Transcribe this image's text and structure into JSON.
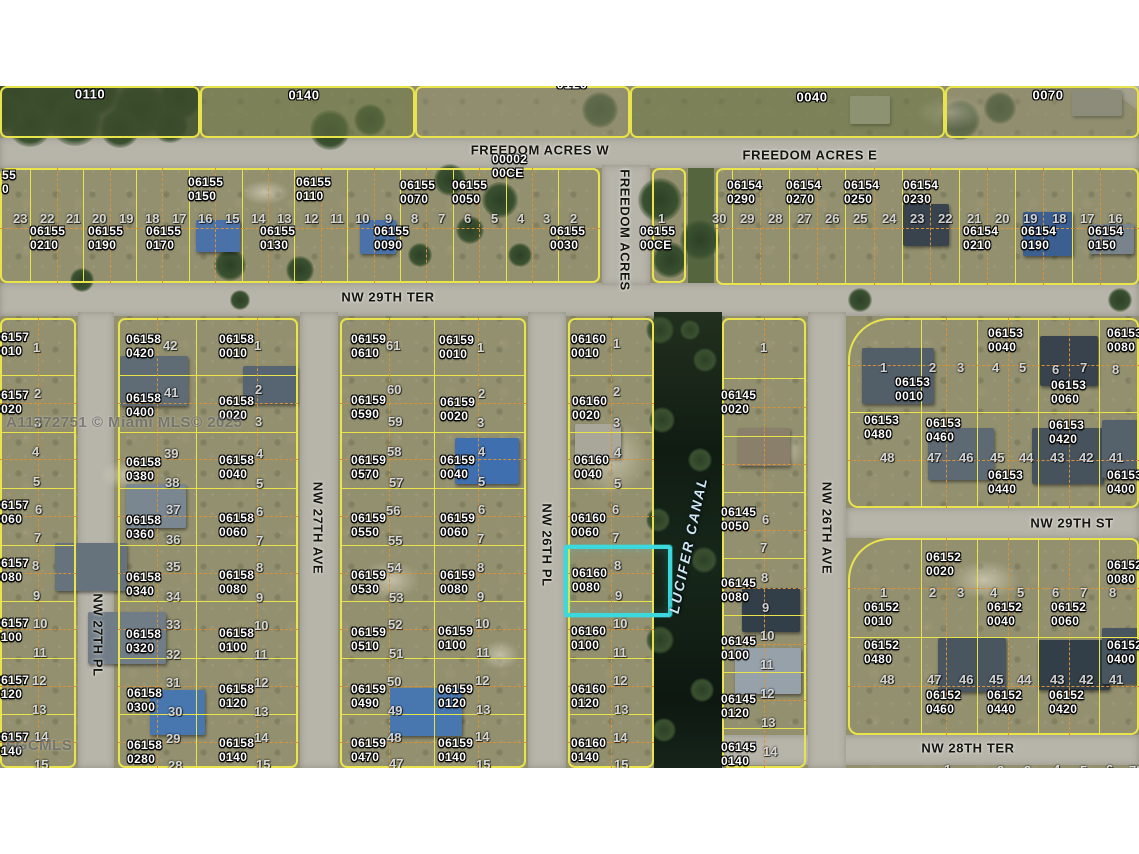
{
  "watermark": {
    "main": "A11772751 © Miami MLS© 2025",
    "corner": "FGCMLS"
  },
  "highlight": {
    "parcel_id": "06160 0080",
    "x": 564,
    "y": 545,
    "w": 100,
    "h": 64,
    "color": "#3bd9de"
  },
  "canal_label": [
    "LUCIFER CANAL",
    688,
    545,
    -78
  ],
  "streets": [
    [
      "FREEDOM ACRES W",
      540,
      150,
      0
    ],
    [
      "FREEDOM ACRES E",
      810,
      155,
      0
    ],
    [
      "NW 29TH TER",
      388,
      297,
      0
    ],
    [
      "NW 29TH ST",
      1072,
      523,
      0
    ],
    [
      "NW 28TH TER",
      968,
      748,
      0
    ],
    [
      "FREEDOM ACRES",
      625,
      230,
      90
    ],
    [
      "NW 27TH PL",
      98,
      635,
      90
    ],
    [
      "NW 27TH AVE",
      318,
      528,
      90
    ],
    [
      "NW 26TH PL",
      547,
      545,
      90
    ],
    [
      "NW 26TH AVE",
      827,
      528,
      90
    ]
  ],
  "top_parcels": [
    [
      "0110",
      90,
      94
    ],
    [
      "0140",
      304,
      95
    ],
    [
      "0120",
      572,
      84
    ],
    [
      "0040",
      812,
      97
    ],
    [
      "0070",
      1048,
      95
    ]
  ],
  "parcel_labels": [
    [
      "55",
      "0",
      2,
      168
    ],
    [
      "06155",
      "0150",
      188,
      175
    ],
    [
      "06155",
      "0110",
      296,
      175
    ],
    [
      "06155",
      "0070",
      400,
      178
    ],
    [
      "06155",
      "0050",
      452,
      178
    ],
    [
      "00002",
      "00CE",
      492,
      152
    ],
    [
      "06155",
      "0210",
      30,
      224
    ],
    [
      "06155",
      "0190",
      88,
      224
    ],
    [
      "06155",
      "0170",
      146,
      224
    ],
    [
      "06155",
      "0130",
      260,
      224
    ],
    [
      "06155",
      "0090",
      374,
      224
    ],
    [
      "06155",
      "0030",
      550,
      224
    ],
    [
      "06155",
      "00CE",
      640,
      224
    ],
    [
      "06154",
      "0290",
      727,
      178
    ],
    [
      "06154",
      "0270",
      786,
      178
    ],
    [
      "06154",
      "0250",
      844,
      178
    ],
    [
      "06154",
      "0230",
      903,
      178
    ],
    [
      "06154",
      "0210",
      963,
      224
    ],
    [
      "06154",
      "0190",
      1021,
      224
    ],
    [
      "06154",
      "0150",
      1088,
      224
    ],
    [
      "06157",
      "0010",
      -6,
      330
    ],
    [
      "06157",
      "0020",
      -6,
      388
    ],
    [
      "06157",
      "0060",
      -6,
      498
    ],
    [
      "06157",
      "0080",
      -6,
      556
    ],
    [
      "06157",
      "0100",
      -6,
      616
    ],
    [
      "06157",
      "0120",
      -6,
      673
    ],
    [
      "06157",
      "0140",
      -6,
      730
    ],
    [
      "06158",
      "0420",
      126,
      332
    ],
    [
      "06158",
      "0400",
      126,
      391
    ],
    [
      "06158",
      "0380",
      126,
      455
    ],
    [
      "06158",
      "0360",
      126,
      513
    ],
    [
      "06158",
      "0340",
      126,
      570
    ],
    [
      "06158",
      "0320",
      126,
      627
    ],
    [
      "06158",
      "0300",
      127,
      686
    ],
    [
      "06158",
      "0280",
      127,
      738
    ],
    [
      "06158",
      "0010",
      219,
      332
    ],
    [
      "06158",
      "0020",
      219,
      394
    ],
    [
      "06158",
      "0040",
      219,
      453
    ],
    [
      "06158",
      "0060",
      219,
      511
    ],
    [
      "06158",
      "0080",
      219,
      568
    ],
    [
      "06158",
      "0100",
      219,
      626
    ],
    [
      "06158",
      "0120",
      219,
      682
    ],
    [
      "06158",
      "0140",
      219,
      736
    ],
    [
      "06159",
      "0610",
      351,
      332
    ],
    [
      "06159",
      "0590",
      351,
      393
    ],
    [
      "06159",
      "0570",
      351,
      453
    ],
    [
      "06159",
      "0550",
      351,
      511
    ],
    [
      "06159",
      "0530",
      351,
      568
    ],
    [
      "06159",
      "0510",
      351,
      625
    ],
    [
      "06159",
      "0490",
      351,
      682
    ],
    [
      "06159",
      "0470",
      351,
      736
    ],
    [
      "06159",
      "0010",
      439,
      333
    ],
    [
      "06159",
      "0020",
      440,
      395
    ],
    [
      "06159",
      "0040",
      440,
      453
    ],
    [
      "06159",
      "0060",
      440,
      511
    ],
    [
      "06159",
      "0080",
      440,
      568
    ],
    [
      "06159",
      "0100",
      438,
      624
    ],
    [
      "06159",
      "0120",
      438,
      682
    ],
    [
      "06159",
      "0140",
      438,
      736
    ],
    [
      "06160",
      "0010",
      571,
      332
    ],
    [
      "06160",
      "0020",
      572,
      394
    ],
    [
      "06160",
      "0040",
      574,
      453
    ],
    [
      "06160",
      "0060",
      571,
      511
    ],
    [
      "06160",
      "0080",
      572,
      566
    ],
    [
      "06160",
      "0100",
      571,
      624
    ],
    [
      "06160",
      "0120",
      571,
      682
    ],
    [
      "06160",
      "0140",
      571,
      736
    ],
    [
      "06145",
      "0020",
      721,
      388
    ],
    [
      "06145",
      "0050",
      721,
      505
    ],
    [
      "06145",
      "0080",
      721,
      576
    ],
    [
      "06145",
      "0100",
      721,
      634
    ],
    [
      "06145",
      "0120",
      721,
      692
    ],
    [
      "06145",
      "0140",
      721,
      740
    ],
    [
      "06153",
      "0040",
      988,
      326
    ],
    [
      "06153",
      "0080",
      1107,
      326
    ],
    [
      "06153",
      "0010",
      895,
      375
    ],
    [
      "06153",
      "0060",
      1051,
      378
    ],
    [
      "06153",
      "0480",
      864,
      413
    ],
    [
      "06153",
      "0460",
      926,
      416
    ],
    [
      "06153",
      "0420",
      1049,
      418
    ],
    [
      "06153",
      "0440",
      988,
      468
    ],
    [
      "06153",
      "0400",
      1107,
      468
    ],
    [
      "06152",
      "0020",
      926,
      550
    ],
    [
      "06152",
      "0080",
      1107,
      558
    ],
    [
      "06152",
      "0010",
      864,
      600
    ],
    [
      "06152",
      "0040",
      987,
      600
    ],
    [
      "06152",
      "0060",
      1051,
      600
    ],
    [
      "06152",
      "0480",
      864,
      638
    ],
    [
      "06152",
      "0400",
      1107,
      638
    ],
    [
      "06152",
      "0460",
      926,
      688
    ],
    [
      "06152",
      "0440",
      987,
      688
    ],
    [
      "06152",
      "0420",
      1049,
      688
    ]
  ],
  "lot_numbers": [
    [
      "1",
      658,
      211
    ],
    [
      "2",
      570,
      211
    ],
    [
      "3",
      543,
      211
    ],
    [
      "4",
      517,
      211
    ],
    [
      "5",
      491,
      211
    ],
    [
      "6",
      464,
      211
    ],
    [
      "7",
      438,
      211
    ],
    [
      "8",
      411,
      211
    ],
    [
      "9",
      385,
      211
    ],
    [
      "10",
      355,
      211
    ],
    [
      "11",
      330,
      211
    ],
    [
      "12",
      304,
      211
    ],
    [
      "13",
      277,
      211
    ],
    [
      "14",
      251,
      211
    ],
    [
      "15",
      225,
      211
    ],
    [
      "16",
      198,
      211
    ],
    [
      "17",
      172,
      211
    ],
    [
      "18",
      145,
      211
    ],
    [
      "19",
      119,
      211
    ],
    [
      "20",
      92,
      211
    ],
    [
      "21",
      66,
      211
    ],
    [
      "22",
      40,
      211
    ],
    [
      "23",
      13,
      211
    ],
    [
      "30",
      712,
      211
    ],
    [
      "29",
      740,
      211
    ],
    [
      "28",
      768,
      211
    ],
    [
      "27",
      797,
      211
    ],
    [
      "26",
      825,
      211
    ],
    [
      "25",
      853,
      211
    ],
    [
      "24",
      882,
      211
    ],
    [
      "23",
      910,
      211
    ],
    [
      "22",
      938,
      211
    ],
    [
      "21",
      967,
      211
    ],
    [
      "20",
      995,
      211
    ],
    [
      "19",
      1023,
      211
    ],
    [
      "18",
      1052,
      211
    ],
    [
      "17",
      1080,
      211
    ],
    [
      "16",
      1108,
      211
    ],
    [
      "1",
      33,
      340
    ],
    [
      "2",
      34,
      386
    ],
    [
      "3",
      34,
      415
    ],
    [
      "4",
      32,
      444
    ],
    [
      "5",
      33,
      474
    ],
    [
      "6",
      35,
      502
    ],
    [
      "7",
      34,
      530
    ],
    [
      "8",
      32,
      558
    ],
    [
      "9",
      33,
      588
    ],
    [
      "10",
      33,
      616
    ],
    [
      "11",
      33,
      645
    ],
    [
      "12",
      32,
      673
    ],
    [
      "13",
      32,
      702
    ],
    [
      "14",
      34,
      729
    ],
    [
      "15",
      34,
      757
    ],
    [
      "42",
      163,
      338
    ],
    [
      "41",
      164,
      385
    ],
    [
      "39",
      164,
      446
    ],
    [
      "38",
      165,
      475
    ],
    [
      "37",
      166,
      502
    ],
    [
      "36",
      166,
      532
    ],
    [
      "35",
      166,
      559
    ],
    [
      "34",
      166,
      589
    ],
    [
      "33",
      166,
      617
    ],
    [
      "32",
      166,
      647
    ],
    [
      "31",
      166,
      675
    ],
    [
      "30",
      168,
      704
    ],
    [
      "29",
      166,
      731
    ],
    [
      "28",
      168,
      758
    ],
    [
      "1",
      254,
      338
    ],
    [
      "2",
      255,
      382
    ],
    [
      "3",
      255,
      414
    ],
    [
      "4",
      256,
      446
    ],
    [
      "5",
      256,
      476
    ],
    [
      "6",
      256,
      504
    ],
    [
      "7",
      256,
      533
    ],
    [
      "8",
      256,
      560
    ],
    [
      "9",
      256,
      590
    ],
    [
      "10",
      254,
      618
    ],
    [
      "11",
      254,
      647
    ],
    [
      "12",
      254,
      675
    ],
    [
      "13",
      254,
      704
    ],
    [
      "14",
      254,
      730
    ],
    [
      "15",
      256,
      757
    ],
    [
      "61",
      386,
      338
    ],
    [
      "60",
      387,
      382
    ],
    [
      "59",
      388,
      414
    ],
    [
      "58",
      387,
      444
    ],
    [
      "57",
      389,
      475
    ],
    [
      "56",
      386,
      503
    ],
    [
      "55",
      388,
      533
    ],
    [
      "54",
      387,
      560
    ],
    [
      "53",
      389,
      590
    ],
    [
      "52",
      388,
      617
    ],
    [
      "51",
      389,
      646
    ],
    [
      "50",
      387,
      674
    ],
    [
      "49",
      388,
      703
    ],
    [
      "48",
      387,
      730
    ],
    [
      "47",
      389,
      756
    ],
    [
      "1",
      477,
      340
    ],
    [
      "2",
      478,
      386
    ],
    [
      "3",
      477,
      415
    ],
    [
      "4",
      478,
      444
    ],
    [
      "5",
      478,
      474
    ],
    [
      "6",
      478,
      502
    ],
    [
      "7",
      477,
      531
    ],
    [
      "8",
      477,
      560
    ],
    [
      "9",
      477,
      589
    ],
    [
      "10",
      475,
      616
    ],
    [
      "11",
      476,
      645
    ],
    [
      "12",
      475,
      673
    ],
    [
      "13",
      476,
      702
    ],
    [
      "14",
      475,
      729
    ],
    [
      "15",
      476,
      757
    ],
    [
      "1",
      613,
      336
    ],
    [
      "2",
      613,
      384
    ],
    [
      "3",
      613,
      415
    ],
    [
      "4",
      614,
      445
    ],
    [
      "5",
      614,
      476
    ],
    [
      "6",
      612,
      502
    ],
    [
      "7",
      612,
      530
    ],
    [
      "8",
      614,
      558
    ],
    [
      "9",
      615,
      588
    ],
    [
      "10",
      613,
      616
    ],
    [
      "11",
      613,
      645
    ],
    [
      "12",
      613,
      673
    ],
    [
      "13",
      614,
      702
    ],
    [
      "14",
      613,
      730
    ],
    [
      "15",
      614,
      757
    ],
    [
      "1",
      760,
      340
    ],
    [
      "6",
      762,
      512
    ],
    [
      "7",
      760,
      540
    ],
    [
      "8",
      761,
      570
    ],
    [
      "9",
      762,
      600
    ],
    [
      "10",
      760,
      628
    ],
    [
      "11",
      760,
      657
    ],
    [
      "12",
      760,
      686
    ],
    [
      "13",
      761,
      715
    ],
    [
      "14",
      763,
      744
    ],
    [
      "1",
      880,
      360
    ],
    [
      "2",
      929,
      360
    ],
    [
      "3",
      957,
      360
    ],
    [
      "4",
      992,
      360
    ],
    [
      "5",
      1019,
      360
    ],
    [
      "6",
      1052,
      362
    ],
    [
      "7",
      1080,
      360
    ],
    [
      "8",
      1112,
      362
    ],
    [
      "48",
      880,
      450
    ],
    [
      "47",
      927,
      450
    ],
    [
      "46",
      959,
      450
    ],
    [
      "45",
      990,
      450
    ],
    [
      "44",
      1019,
      450
    ],
    [
      "43",
      1050,
      450
    ],
    [
      "42",
      1079,
      450
    ],
    [
      "41",
      1109,
      450
    ],
    [
      "1",
      880,
      585
    ],
    [
      "2",
      929,
      585
    ],
    [
      "3",
      957,
      585
    ],
    [
      "4",
      990,
      585
    ],
    [
      "5",
      1017,
      585
    ],
    [
      "6",
      1052,
      585
    ],
    [
      "7",
      1080,
      585
    ],
    [
      "8",
      1109,
      585
    ],
    [
      "48",
      880,
      672
    ],
    [
      "47",
      927,
      672
    ],
    [
      "46",
      959,
      672
    ],
    [
      "45",
      989,
      672
    ],
    [
      "44",
      1017,
      672
    ],
    [
      "43",
      1050,
      672
    ],
    [
      "42",
      1079,
      672
    ],
    [
      "41",
      1109,
      672
    ],
    [
      "1",
      944,
      762
    ],
    [
      "2",
      997,
      763
    ],
    [
      "3",
      1024,
      763
    ],
    [
      "4",
      1053,
      762
    ],
    [
      "5",
      1080,
      763
    ],
    [
      "6",
      1106,
      762
    ],
    [
      "7",
      1129,
      763
    ],
    [
      "8",
      1136,
      763
    ]
  ]
}
